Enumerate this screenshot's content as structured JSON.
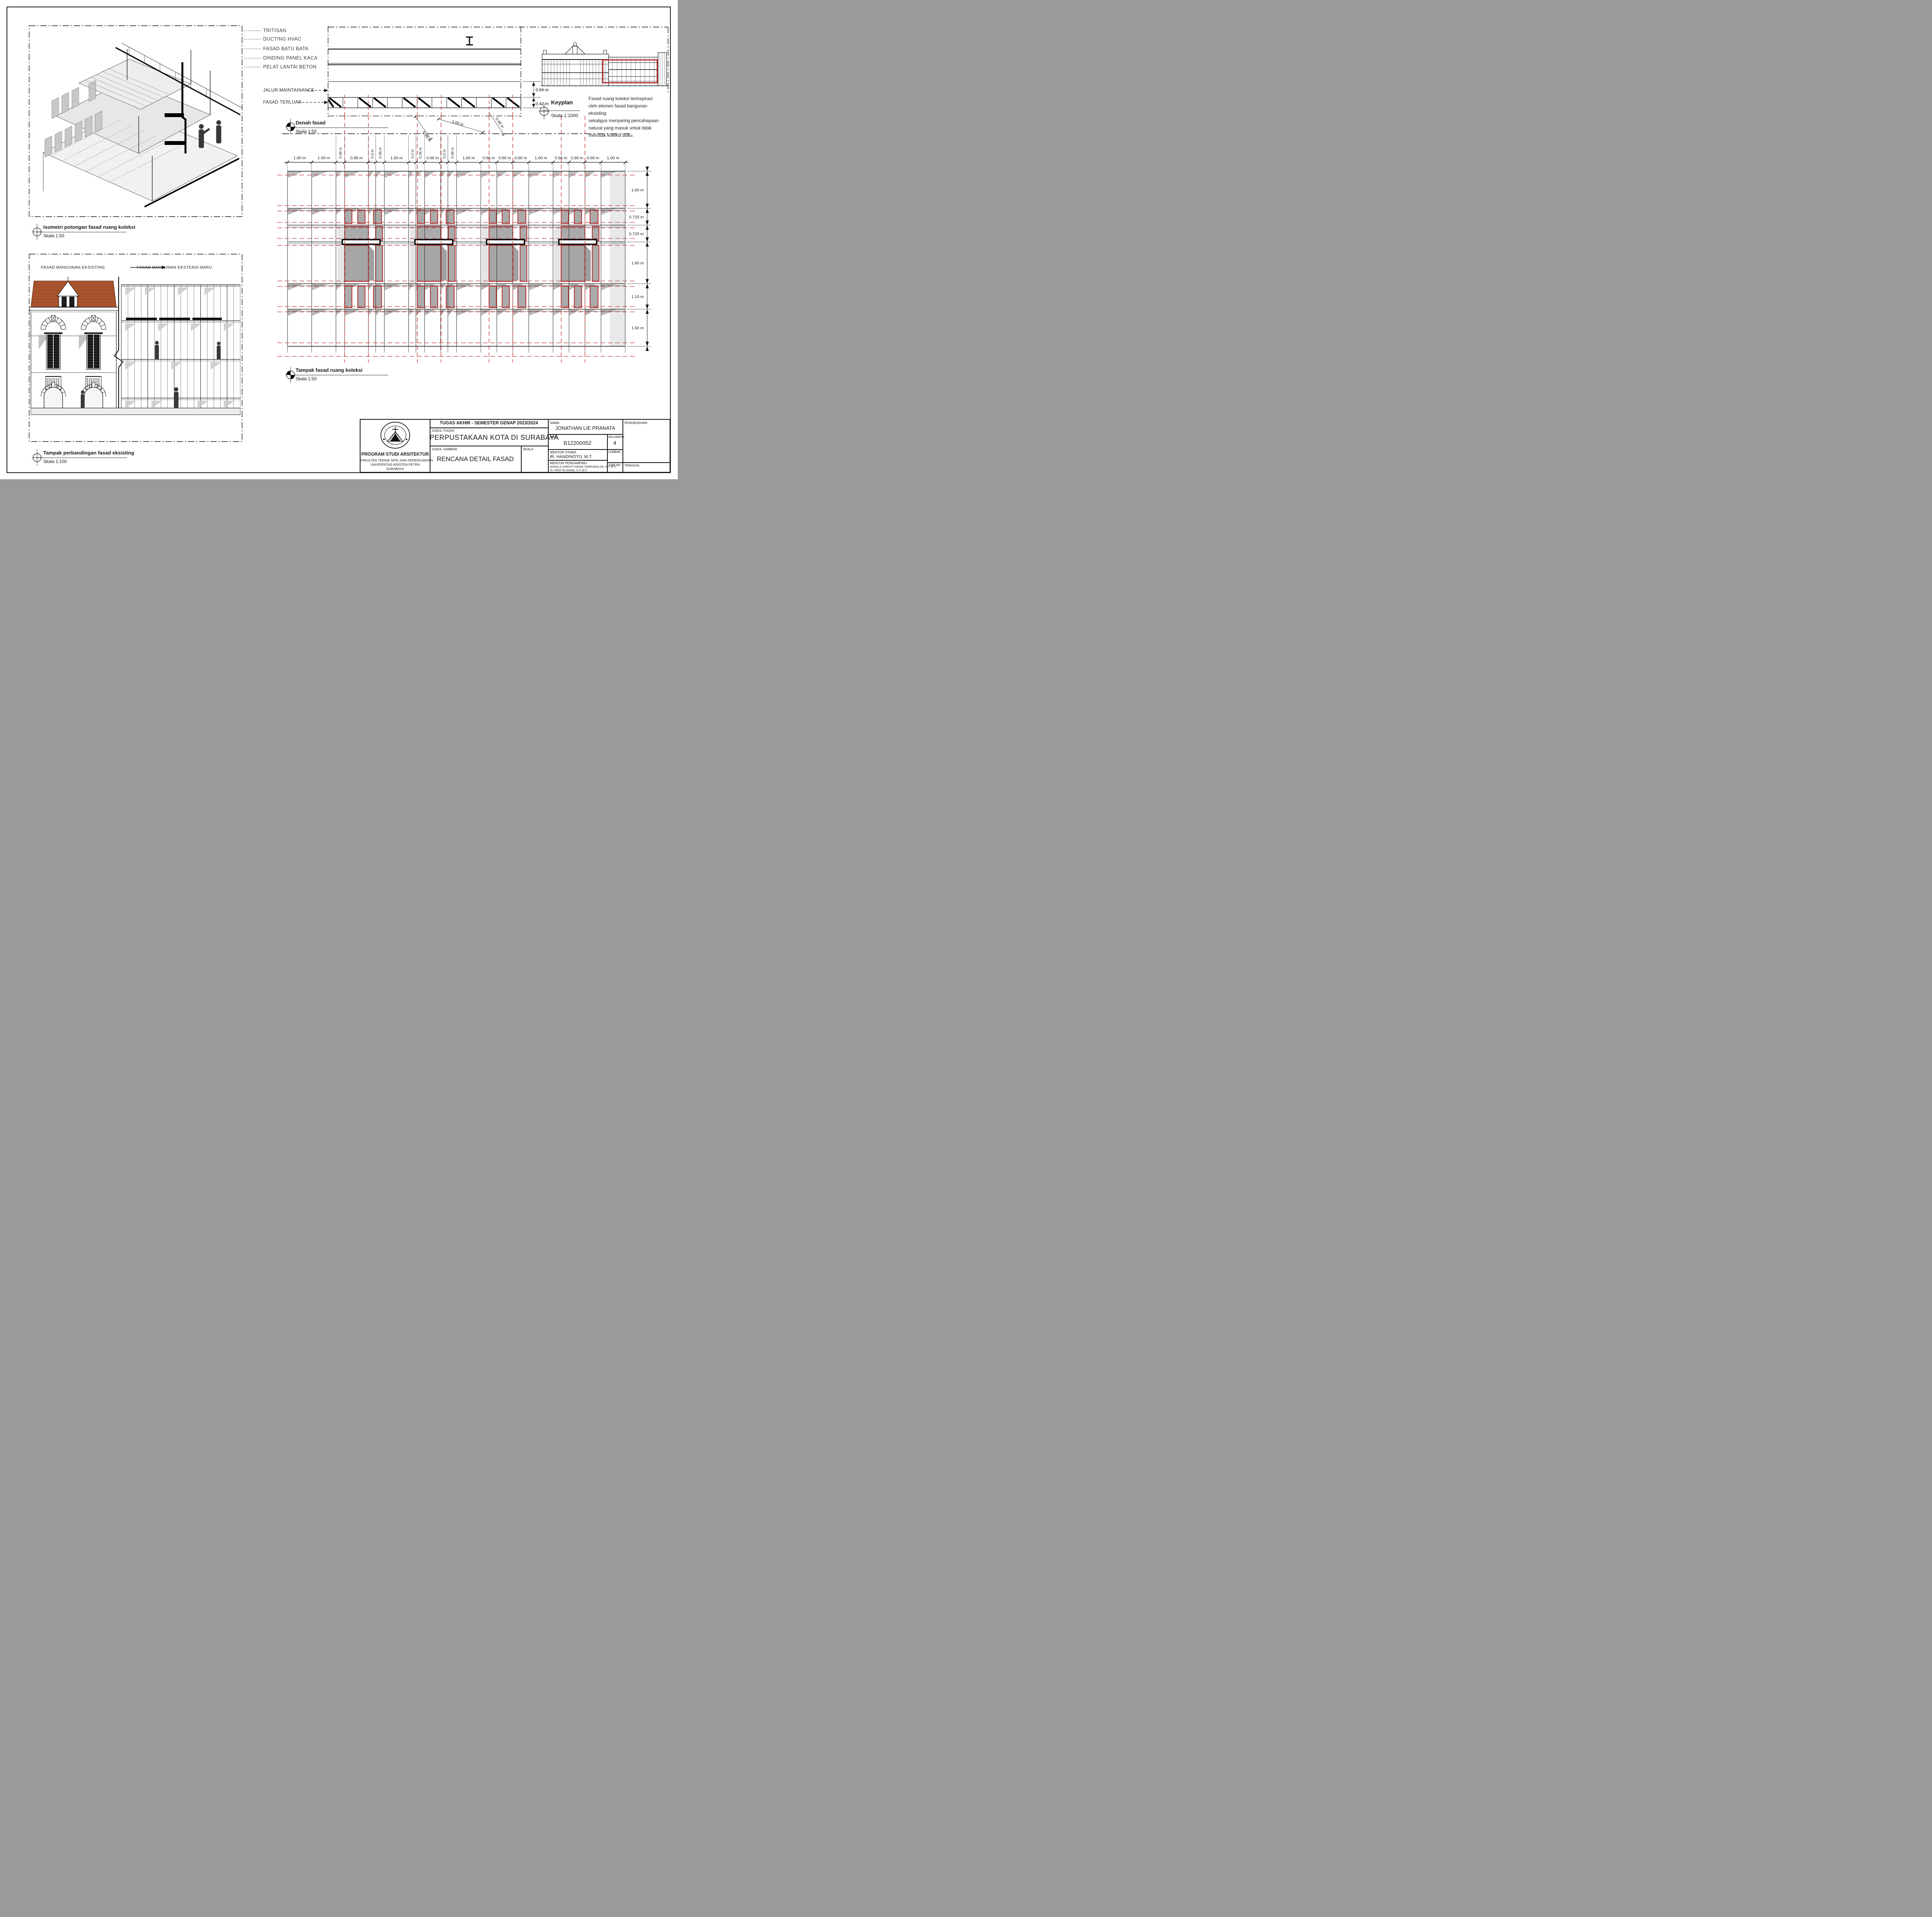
{
  "colors": {
    "accent_red": "#B22A2A",
    "dash_red": "#C03434",
    "panel_gray": "#ABABAB",
    "shadow_gray": "#B3B3B3",
    "light_gray": "#E4E4E4",
    "roof_orange": "#A9542F"
  },
  "callouts": {
    "items": [
      "TRITISAN",
      "DUCTING HVAC",
      "FASAD BATU BATA",
      "DINDING PANEL KACA",
      "PELAT LANTAI BETON"
    ]
  },
  "plan": {
    "title": "Denah fasad",
    "scale": "Skala 1:50",
    "jalur_label": "JALUR MAINTAINANCE",
    "terluar_label": "FASAD TERLUAR",
    "dim_top": "0.64 m",
    "dim_bottom": "0.42 m",
    "diag_dims": [
      "0.48 m",
      "1.05 m",
      "0.48 m"
    ]
  },
  "keyplan": {
    "title": "Keyplan",
    "scale": "Skala 1:1000",
    "note_lines": [
      "Fasad ruang koleksi terinspirasi",
      "oleh elemen fasad bangunan eksisting",
      "sekaligus menyaring pencahayaan",
      "natural yang masuk untuk tidak",
      "merusak koleksi buku."
    ]
  },
  "iso": {
    "title": "Isometri potongan fasad ruang koleksi",
    "scale": "Skala 1:50"
  },
  "elevation": {
    "title": "Tampak fasad ruang koleksi",
    "scale": "Skala 1:50",
    "h_dims": [
      "1.00 m",
      "1.00 m",
      "0.36 m",
      "0.98 m",
      "0.3 m",
      "0.36 m",
      "1.00 m",
      "0.3 m",
      "0.36 m",
      "0.66 m",
      "0.3 m",
      "0.36 m",
      "1.00 m",
      "0.66 m",
      "0.66 m",
      "0.66 m",
      "1.00 m",
      "0.66 m",
      "0.66 m",
      "0.66 m",
      "1.00 m"
    ],
    "v_dims": [
      "1.60 m",
      "0.725 m",
      "0.725 m",
      "1.80 m",
      "1.10 m",
      "1.60 m"
    ]
  },
  "comparison": {
    "title": "Tampak perbandingan fasad eksisting",
    "scale": "Skala 1:100",
    "label_left": "FASAD BANGUNAN EKSISTING",
    "label_right": "FASAD BANGUNAN EKSTENSI BARU"
  },
  "titleblock": {
    "header": "TUGAS AKHIR - SEMESTER GENAP 2023/2024",
    "labels": {
      "judul_tugas": "JUDUL TUGAS",
      "judul_gambar": "JUDUL GAMBAR",
      "skala": "SKALA",
      "nama": "NAMA",
      "nrp": "NRP",
      "kelompok": "KELOMPOK",
      "mentor_utama": "MENTOR UTAMA",
      "mentor_pendamping": "MENTOR PENDAMPING",
      "lembar": "LEMBAR",
      "jumlah": "JUMLAH",
      "tanggal": "TANGGAL",
      "pengesahan": "PENGESAHAN"
    },
    "values": {
      "project_title": "PERPUSTAKAAN KOTA DI SURABAYA",
      "drawing_title": "RENCANA DETAIL FASAD",
      "student_name": "JONATHAN LIE PRANATA",
      "nrp": "B12200052",
      "kelompok": "4",
      "mentor_utama": "IR. HANDINOTO, M.T.",
      "mentor_pendamping": [
        "ANGELA CHRISTYSONIA TAMPUBOLON, S.T.,M.T.",
        "Dr. FENY ELSIANA, S.T.,M.T."
      ]
    },
    "institution_lines": [
      "PROGRAM STUDI ARSITEKTUR",
      "FAKULTAS TEKNIK SIPIL DAN PERENCANAAN",
      "UNIVERSITAS KRISTEN PETRA",
      "SURABAYA"
    ]
  }
}
